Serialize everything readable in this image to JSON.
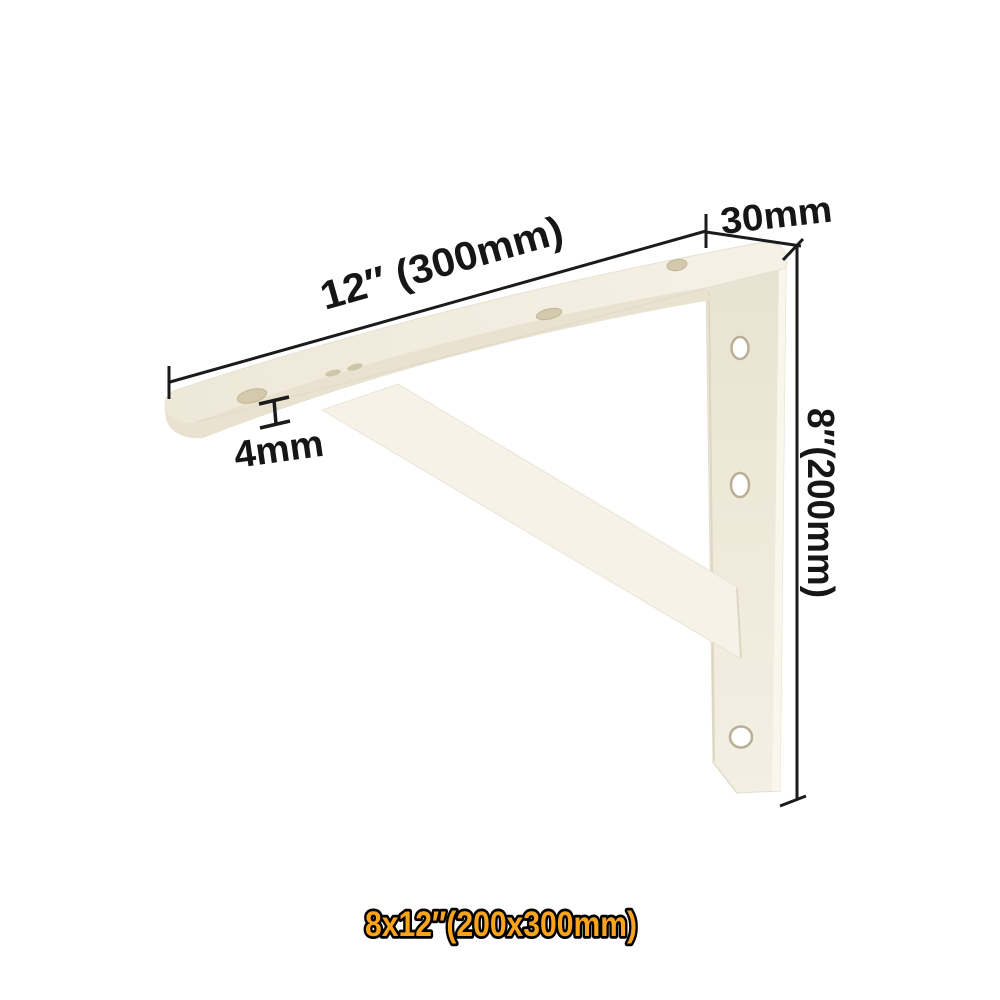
{
  "canvas": {
    "background": "#ffffff"
  },
  "diagram": {
    "ink_color": "#1b1b1b",
    "bracket_colors": {
      "top_face": "#f3eee1",
      "front_edge": "#e9e2d1",
      "plate_face": "#ece6d7",
      "brace_face": "#f6f2e8"
    },
    "annotations": {
      "length": "12″ (300mm)",
      "width": "30mm",
      "thickness": "4mm",
      "height": "8″(200mm)"
    }
  },
  "caption": {
    "text": "8x12″(200x300mm)",
    "fill": "#f9a41c",
    "outline": "#000000"
  }
}
